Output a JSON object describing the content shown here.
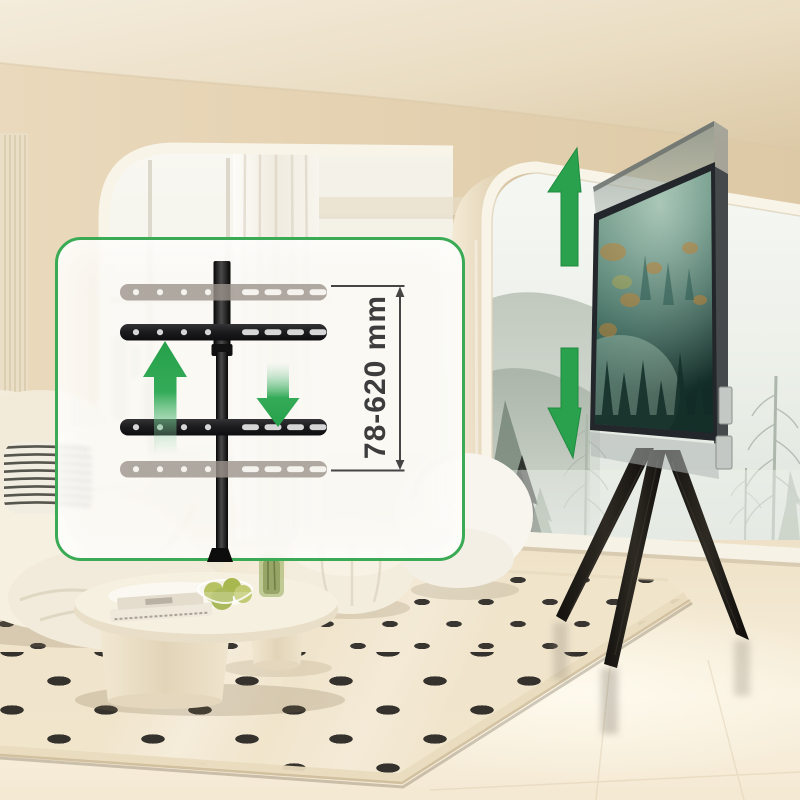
{
  "scene": {
    "description": "Beige living room with height-adjustable TV floor stand",
    "tv_screen_subject": "misty green forest with sun rays and autumn patches"
  },
  "inset_diagram": {
    "measurement_label": "78-620 mm",
    "up_arrow_icon": "green-up-arrow-icon",
    "down_arrow_icon": "green-down-arrow-icon"
  },
  "tv_annotation": {
    "up_arrow_icon": "green-up-arrow-icon",
    "down_arrow_icon": "green-down-arrow-icon"
  },
  "colors": {
    "accent_green": "#2aa24d",
    "box_border_green": "#3aaa55",
    "dimension_line": "#454545",
    "bracket_black": "#1d1d1f",
    "ghost_gray": "#9d948c"
  }
}
